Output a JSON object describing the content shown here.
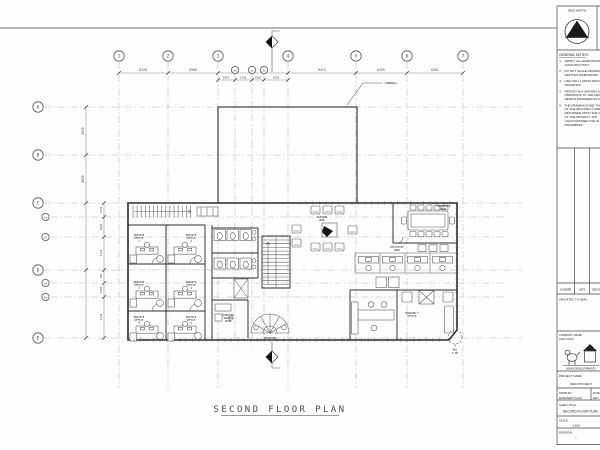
{
  "sheet": {
    "plan_title": "SECOND FLOOR PLAN",
    "awning_note": "(AWNING)",
    "detail_note": [
      "RWL",
      "0.5M"
    ]
  },
  "plan": {
    "grids_top": [
      {
        "label": "1",
        "x": 119
      },
      {
        "label": "2",
        "x": 168
      },
      {
        "label": "3",
        "x": 218
      },
      {
        "label": "3a",
        "x": 235,
        "minor": true
      },
      {
        "label": "3y",
        "x": 252,
        "minor": true
      },
      {
        "label": "3z",
        "x": 264,
        "minor": true
      },
      {
        "label": "4",
        "x": 288
      },
      {
        "label": "5",
        "x": 356
      },
      {
        "label": "6",
        "x": 407
      },
      {
        "label": "7",
        "x": 463
      }
    ],
    "grids_left": [
      {
        "label": "A",
        "y": 107
      },
      {
        "label": "B",
        "y": 155
      },
      {
        "label": "C",
        "y": 203
      },
      {
        "label": "Ca",
        "y": 217,
        "minor": true
      },
      {
        "label": "Cy",
        "y": 237,
        "minor": true
      },
      {
        "label": "D",
        "y": 270
      },
      {
        "label": "Da",
        "y": 283,
        "minor": true
      },
      {
        "label": "Dy",
        "y": 297,
        "minor": true
      },
      {
        "label": "E",
        "y": 338
      }
    ],
    "dims_top": [
      {
        "text": "8128",
        "x": 143,
        "y": 71
      },
      {
        "text": "8586",
        "x": 193,
        "y": 71
      },
      {
        "text": "8474",
        "x": 322,
        "y": 71
      },
      {
        "text": "6435",
        "x": 381,
        "y": 71
      },
      {
        "text": "6281",
        "x": 435,
        "y": 71
      },
      {
        "text": "1952",
        "x": 226,
        "y": 78.5,
        "small": true
      },
      {
        "text": "2158",
        "x": 243,
        "y": 78.5,
        "small": true
      },
      {
        "text": "1850",
        "x": 258,
        "y": 78.5,
        "small": true
      },
      {
        "text": "2608",
        "x": 276,
        "y": 78.5,
        "small": true
      }
    ],
    "dims_left": [
      {
        "text": "6020",
        "x": 84,
        "y": 131
      },
      {
        "text": "6000",
        "x": 84,
        "y": 179
      },
      {
        "text": "1533",
        "x": 102,
        "y": 210
      },
      {
        "text": "3095",
        "x": 102,
        "y": 227
      },
      {
        "text": "4118",
        "x": 102,
        "y": 253
      },
      {
        "text": "706",
        "x": 102,
        "y": 276
      },
      {
        "text": "3300",
        "x": 102,
        "y": 290
      },
      {
        "text": "5178",
        "x": 102,
        "y": 317
      }
    ],
    "rooms": [
      {
        "lines": [
          "PRIVATE",
          "OFFICE",
          "1"
        ],
        "x": 139,
        "y": 236
      },
      {
        "lines": [
          "PRIVATE",
          "OFFICE",
          "2"
        ],
        "x": 191,
        "y": 236
      },
      {
        "lines": [
          "PRIVATE",
          "OFFICE",
          "3"
        ],
        "x": 139,
        "y": 283
      },
      {
        "lines": [
          "PRIVATE",
          "OFFICE",
          "4"
        ],
        "x": 191,
        "y": 283
      },
      {
        "lines": [
          "PRIVATE",
          "OFFICE",
          "5"
        ],
        "x": 139,
        "y": 318
      },
      {
        "lines": [
          "PRIVATE",
          "OFFICE",
          "6"
        ],
        "x": 191,
        "y": 318
      },
      {
        "lines": [
          "COMPUTER",
          "SERVER",
          "ROOM"
        ],
        "x": 228,
        "y": 316
      },
      {
        "lines": [
          "WAITING",
          "AREA"
        ],
        "x": 322,
        "y": 218
      },
      {
        "lines": [
          "CONFERENCE",
          "ROOM"
        ],
        "x": 443,
        "y": 207
      },
      {
        "lines": [
          "PHOTOCOPY",
          "AREA"
        ],
        "x": 397,
        "y": 248
      },
      {
        "lines": [
          "MANAGER'S",
          "OFFICE"
        ],
        "x": 412,
        "y": 314
      },
      {
        "lines": [
          "RECEPTION"
        ],
        "x": 270,
        "y": 339
      }
    ]
  },
  "titleblock": {
    "grid_north_label": "GRID NORTH",
    "general_notes_title": "GENERAL NOTES:",
    "notes": [
      "VERIFY ALL DIMENSIONS PRIOR TO CONSTRUCTION.",
      "DO NOT SCALE DRAWINGS. USE WRITTEN DIMENSIONS.",
      "USE ONLY LATEST REVISED DRAWINGS.",
      "REPORT ANY ERRORS AND OMISSIONS TO THE ARCHITECT OR DESIGN ENGINEER AS APPLICABLE.",
      "THE DRAWINGS ARE THE PROPERTY OF THE ARCHITECT AND MUST BE RETURNED UPON THE COMPLETION OF THE PROJECT. ANY UNAUTHORIZED USE IS PROHIBITED."
    ],
    "revision_headers": [
      "NUMBER",
      "DATE",
      "DESCRIPTION"
    ],
    "architects_seal_label": "ARCHITECT'S SEAL",
    "company_label_line1": "COMPANY NAME",
    "company_label_line2": "AND LOGO",
    "company_name": "LEWIS DEVELOPMENTS",
    "project_name_label": "PROJECT NAME:",
    "project_name": "MAIN PROJECT",
    "drawn_by_label": "DRWN BY:",
    "drawn_by": "MARGARET KAUR",
    "date_label": "DATE:",
    "date_value": "DEC",
    "sheet_title_label": "SHEET TITLE:",
    "sheet_title": "SECOND FLOOR PLAN",
    "scale_label": "SCALE:",
    "scale_value": "1:100",
    "revision_label": "REVISION:",
    "revision_value": "--"
  }
}
